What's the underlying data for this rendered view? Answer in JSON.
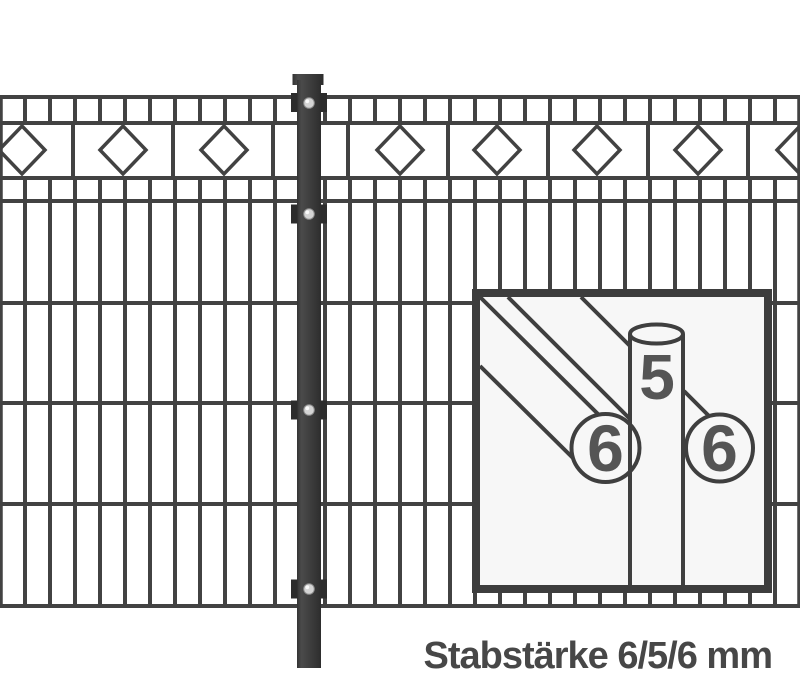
{
  "figure": {
    "caption": "Stabstärke 6/5/6 mm",
    "inset": {
      "label_front_rod": "6",
      "label_vertical_rod": "5",
      "label_back_rod": "6"
    },
    "rod_diameters_mm": {
      "horizontal_rods": 6,
      "vertical_rods": 5,
      "unit": "mm"
    },
    "colors": {
      "background": "#ffffff",
      "wire": "#424242",
      "post": "#3a3a3a",
      "bracket": "#2c2c2c",
      "screw": "#d4d4d4",
      "inset_background": "#f7f7f7",
      "inset_border": "#3d3d3d",
      "label_text": "#555555",
      "caption_text": "#474747"
    }
  }
}
